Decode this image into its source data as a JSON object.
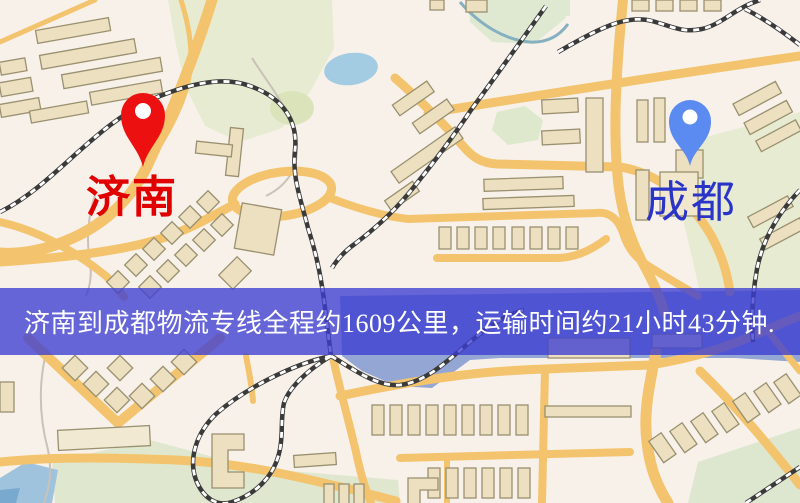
{
  "banner": {
    "text": "济南到成都物流专线全程约1609公里，运输时间约21小时43分钟.",
    "bg": "rgba(60,62,210,0.78)",
    "text_color": "#ffffff"
  },
  "origin": {
    "label": "济南",
    "label_color": "#e00000",
    "pin_color": "#ec1010"
  },
  "destination": {
    "label": "成都",
    "label_color": "#2a35c8",
    "pin_color": "#5b8bf0"
  },
  "map": {
    "background": "#f8f1ea",
    "road_color": "#f3c46d",
    "park_color": "#e7ebd2",
    "water_color": "#a3cbe2",
    "building_fill": "#ece0c0",
    "building_stroke": "#99906f",
    "railway_color": "#3a3a3a"
  }
}
